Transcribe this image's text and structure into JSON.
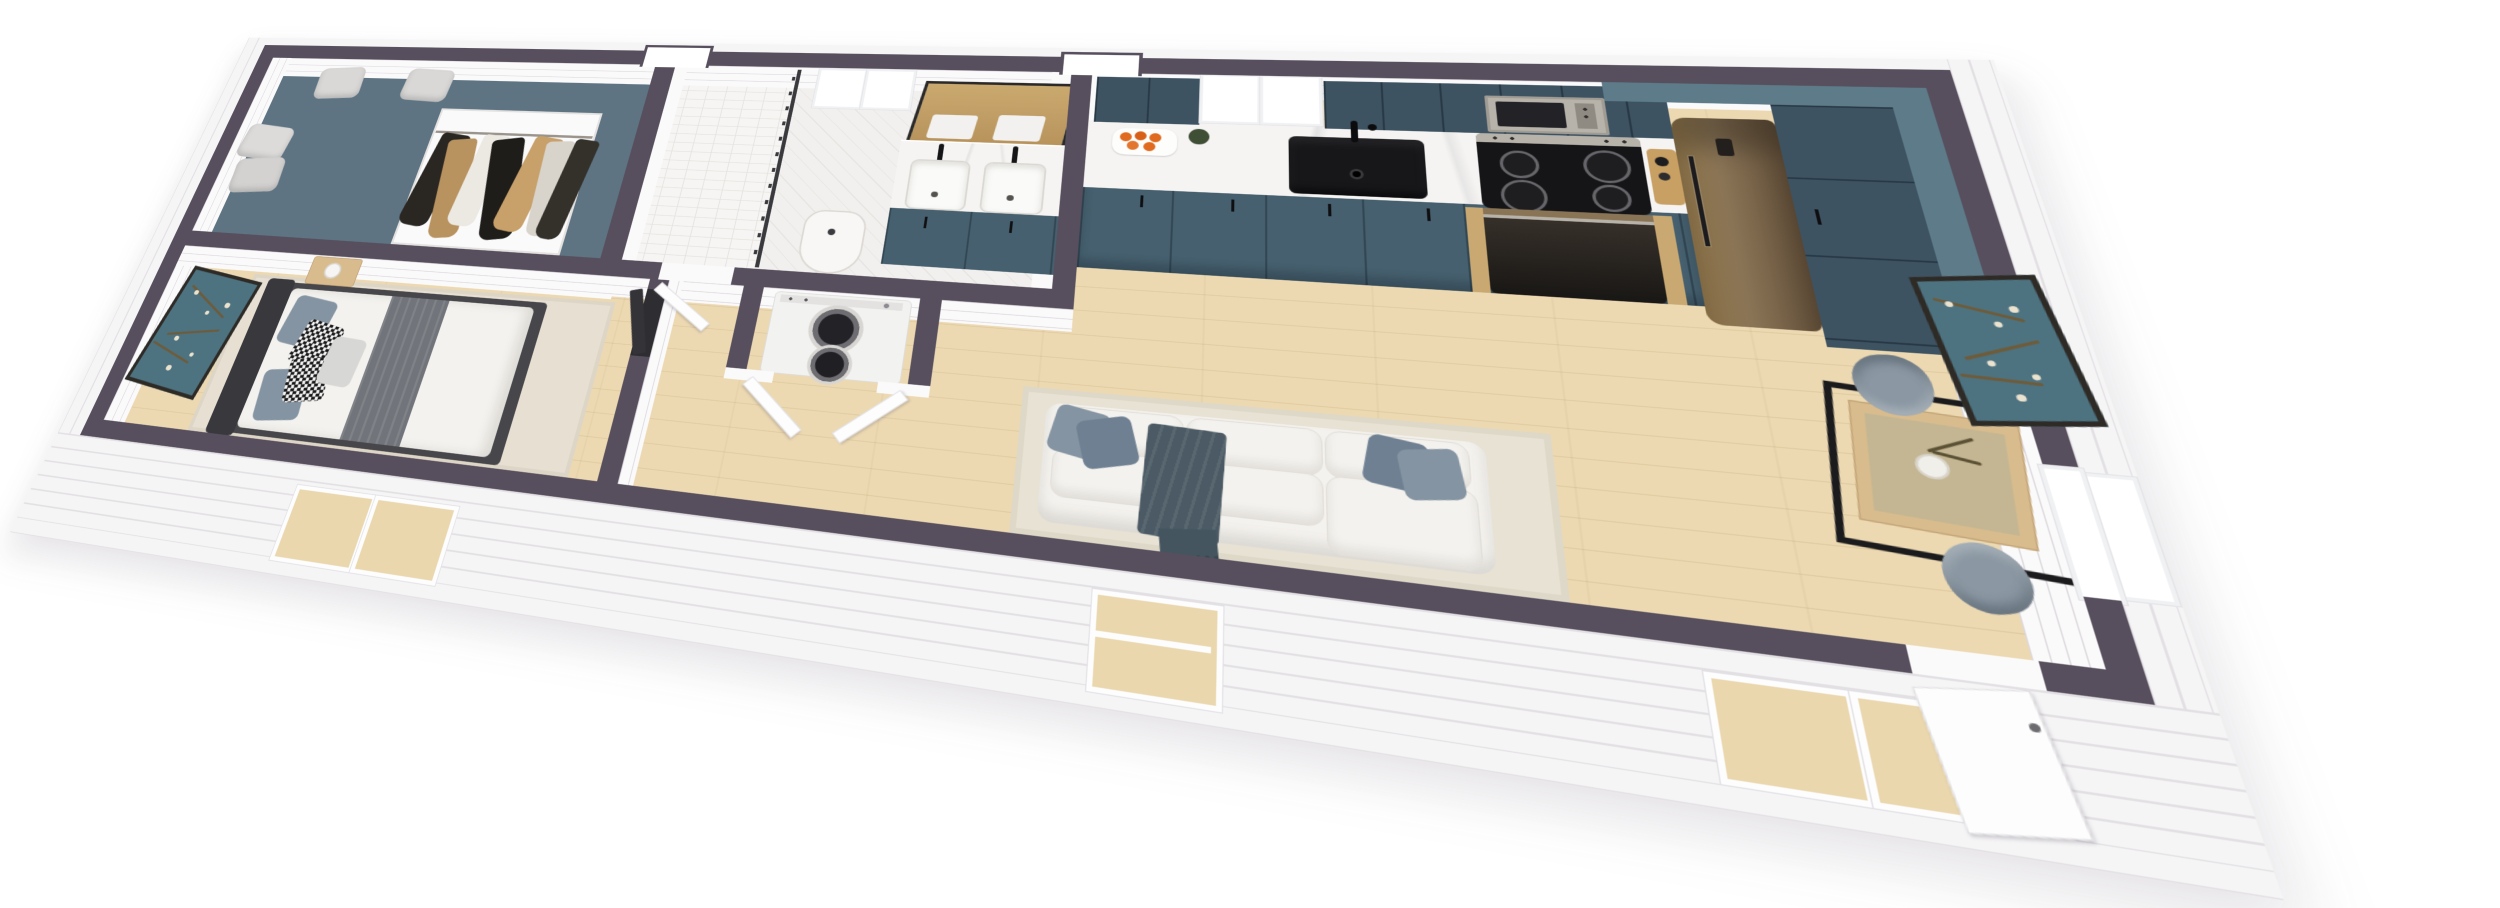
{
  "scene": {
    "kind": "3d-floorplan-render",
    "width": 2500,
    "height": 908,
    "background": "#ffffff"
  },
  "colors": {
    "wall": "#574f5d",
    "skirt": "#f6f5f6",
    "skirt_line": "#e3e0e4",
    "facing": "#fbfafb",
    "facing_line": "#dcd8dd",
    "wood": "#ecd9b2",
    "slate": "#5e7483",
    "teal": "#46606f",
    "teal_dark": "#3d5362",
    "soffit": "#5d7b89",
    "marble": "#f5f4f2",
    "ink": "#17171a",
    "steel": "#b7b2aa",
    "bronze": "#8a7456",
    "bronze_dark": "#63503a",
    "sofa": "#f4f2ee",
    "sofa_shadow": "#e1ded7",
    "pillow": "#8494a2",
    "pillow2": "#6e8092",
    "throw": "#4b5a64",
    "rug": "#e8e2d4",
    "rug2": "#e6dfd2",
    "platform": "#47474b",
    "headboard": "#38383d",
    "runner": "#71757b",
    "art_teal": "#4d7280",
    "art_frame": "#2e2a26",
    "branch": "#6f5b38",
    "blossom": "#ece3cf",
    "wood_furn": "#d9bc8e",
    "orange": "#e06a1f",
    "plant": "#3e4f36",
    "tile": "#f6f5f3",
    "tile_line": "#e5e3df",
    "door_dark": "#2e2d32",
    "chair": "#8b98a3",
    "white": "#ffffff"
  },
  "building": {
    "style": "single-story tiny home, aerial cutaway render, dark wall caps, white shiplap exterior",
    "rooms": [
      {
        "name": "walk-in-closet",
        "items": [
          "slate-floor-rug",
          "ottoman",
          "ottoman",
          "ottoman",
          "ottoman",
          "hanging-clothes"
        ]
      },
      {
        "name": "bedroom",
        "items": [
          "wall-art-almond-blossom",
          "area-rug",
          "platform-bed",
          "headboard",
          "gray-bed-runner",
          "throw-pillows",
          "houndstooth-pillows",
          "nightstand",
          "table-lamp",
          "doorway"
        ]
      },
      {
        "name": "bathroom",
        "items": [
          "walk-in-shower",
          "shower-curtain-rod",
          "window",
          "toilet",
          "double-vanity",
          "vanity-mirror",
          "black-faucets",
          "teal-vanity-cabinet",
          "door"
        ]
      },
      {
        "name": "laundry-closet",
        "items": [
          "stacked-washer-dryer",
          "bifold-doors"
        ]
      },
      {
        "name": "kitchen",
        "items": [
          "window",
          "upper-cabinets",
          "microwave",
          "marble-countertop",
          "fruit-tray",
          "potted-plant",
          "black-sink",
          "black-faucet",
          "range-cooktop",
          "oven",
          "cutting-board",
          "refrigerator",
          "pantry-cabinets",
          "corner-soffit",
          "lower-cabinets"
        ]
      },
      {
        "name": "living-room",
        "items": [
          "area-rug",
          "white-sectional-sofa",
          "throw-pillows",
          "throw-blanket",
          "window"
        ]
      },
      {
        "name": "dining-area",
        "items": [
          "square-glass-top-table",
          "black-metal-table-base",
          "vase-with-branches",
          "shell-chair",
          "shell-chair",
          "wall-art-almond-blossom",
          "window",
          "entry-door"
        ]
      }
    ],
    "exterior": [
      "white-shiplap-skirt",
      "bedroom-windows",
      "living-room-window",
      "dining-windows",
      "entry-door",
      "side-window",
      "roofline-niches"
    ]
  }
}
